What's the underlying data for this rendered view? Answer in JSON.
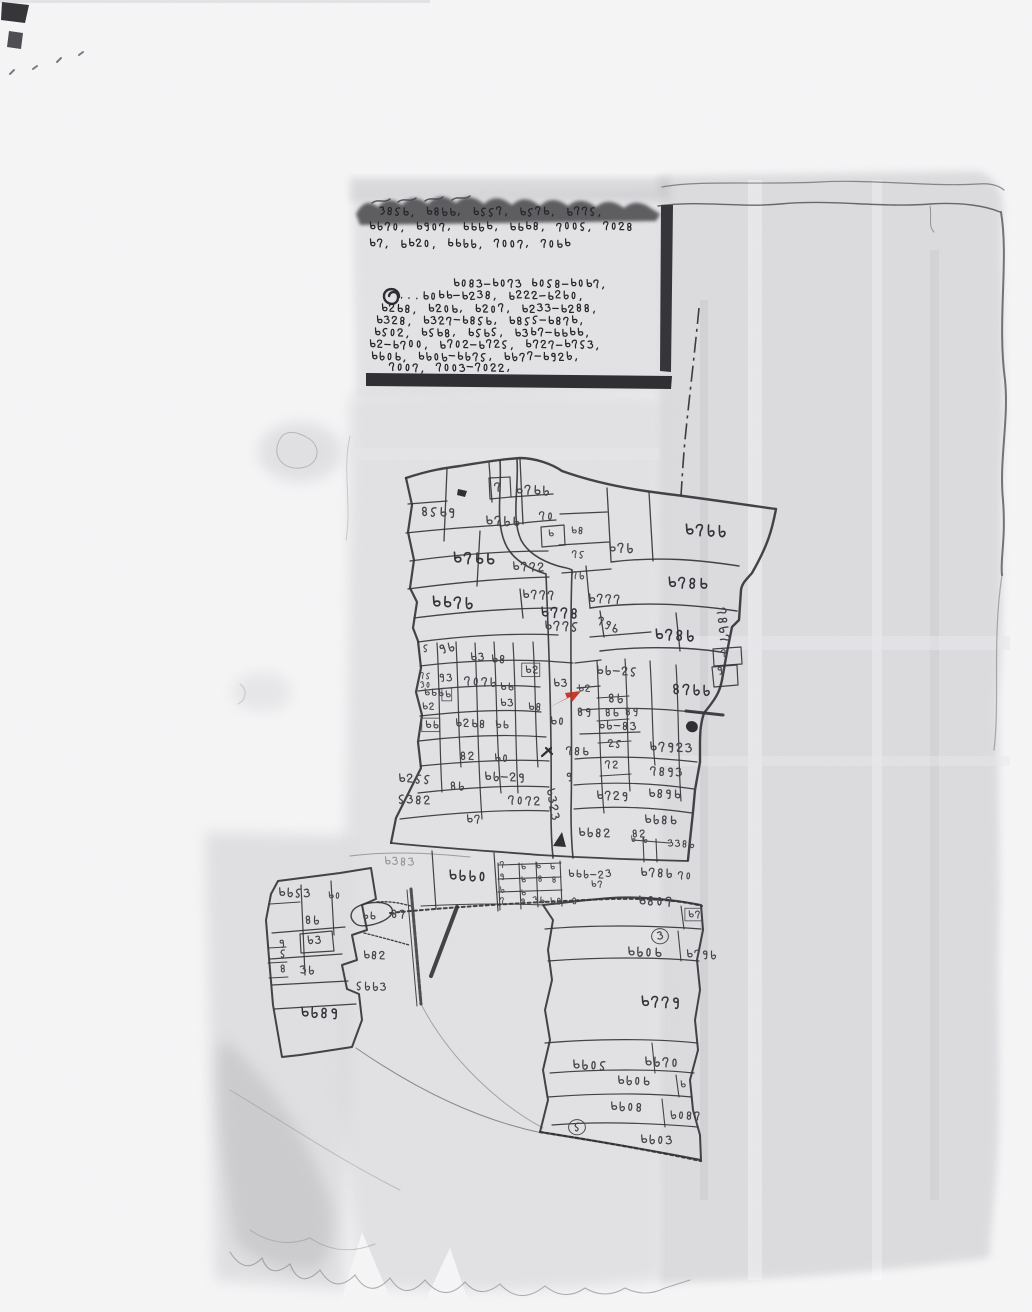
{
  "document": {
    "kind_label": "scanned-hand-drawn-cadastral-mouza-map",
    "ink_color": "#3a3a40",
    "red_mark_color": "#c03026",
    "paper_color": "#f6f6f7",
    "wash_color": "#c9c9cd"
  },
  "notes_block": {
    "lines": [
      {
        "x": 378,
        "y": 206,
        "text": "১৪৫৬, ৬৪৮৬, ৬৫৫৭, ৬৫৭৬, ৬৭৭৫,"
      },
      {
        "x": 368,
        "y": 221,
        "text": "৬৮৭০, ৬৯০৭, ৬৬৮৬, ৬৬৬৪, ৭০০৫, ৭০২৪"
      },
      {
        "x": 368,
        "y": 238,
        "text": "৬৭, ৬৬২০, ৬৬৮৮, ৭০০৭, ৭০৬৬"
      },
      {
        "x": 452,
        "y": 278,
        "text": "৬০৪৩-৬০৭৩ ৬০৫৪-৬০৬৭,"
      },
      {
        "x": 398,
        "y": 290,
        "text": "...৬০৬৬-৬২৩৪, ৬২২২-৬২৮০,"
      },
      {
        "x": 380,
        "y": 303,
        "text": "৬২৬৪, ৬২০৬, ৬২০৭, ৬২৩৩-৬২৪৪,"
      },
      {
        "x": 375,
        "y": 315,
        "text": "৬৩২৪, ৬৩২৭-৬৪৫৬, ৬৪৫৫-৬৪৭৬,"
      },
      {
        "x": 373,
        "y": 327,
        "text": "৬৫০২, ৬৫৬৪, ৬৫৬৫, ৬৩৬৭-৬৬৬৬,"
      },
      {
        "x": 368,
        "y": 339,
        "text": "৬২-৬৭০০, ৬৭০২-৬৭২৫, ৬৭২৭-৬৭৫৩,"
      },
      {
        "x": 370,
        "y": 351,
        "text": "৬৮০৬, ৬৮০৮-৬৮৭৫, ৬৮৭৭-৬৯২৮,"
      },
      {
        "x": 388,
        "y": 362,
        "text": "৭০০৭, ৭০০৩-৭০২২,"
      }
    ]
  },
  "highlight": {
    "red_arrow_plot": "৬৩"
  },
  "map_labels": [
    {
      "x": 493,
      "y": 482,
      "t": "৭"
    },
    {
      "x": 514,
      "y": 484,
      "t": "৬৭৬৮",
      "s": 0.9
    },
    {
      "x": 420,
      "y": 506,
      "t": "৪৫৬৯",
      "s": 0.9
    },
    {
      "x": 484,
      "y": 515,
      "t": "৬৭৮৬",
      "s": 0.9
    },
    {
      "x": 538,
      "y": 511,
      "t": "৭০",
      "s": 0.8
    },
    {
      "x": 547,
      "y": 529,
      "t": "৬",
      "s": 0.7
    },
    {
      "x": 570,
      "y": 526,
      "t": "৬৪",
      "s": 0.7
    },
    {
      "x": 683,
      "y": 523,
      "t": "৬৭৮৮",
      "s": 1.1
    },
    {
      "x": 607,
      "y": 542,
      "t": "৬৭৮",
      "s": 0.9
    },
    {
      "x": 451,
      "y": 551,
      "t": "৬৭৬৬",
      "s": 1.1
    },
    {
      "x": 511,
      "y": 561,
      "t": "৬৭৭২",
      "s": 0.85
    },
    {
      "x": 571,
      "y": 550,
      "t": "৭৫",
      "s": 0.7
    },
    {
      "x": 571,
      "y": 571,
      "t": "৭৮",
      "s": 0.7
    },
    {
      "x": 666,
      "y": 576,
      "t": "৬৭৪৬",
      "s": 1.05
    },
    {
      "x": 430,
      "y": 595,
      "t": "৬৬৭৮",
      "s": 1.1
    },
    {
      "x": 521,
      "y": 589,
      "t": "৬৭৭৭",
      "s": 0.85
    },
    {
      "x": 587,
      "y": 593,
      "t": "৬৭৭৭",
      "s": 0.85
    },
    {
      "x": 539,
      "y": 606,
      "t": "৬৭৭৪",
      "s": 1.0
    },
    {
      "x": 599,
      "y": 615,
      "t": "৭৯৬",
      "s": 0.8,
      "r": 25
    },
    {
      "x": 543,
      "y": 620,
      "t": "৬৭৭৫",
      "s": 0.9
    },
    {
      "x": 653,
      "y": 628,
      "t": "৬৭৪৮",
      "s": 1.05
    },
    {
      "x": 726,
      "y": 606,
      "t": "৭৪৮৭",
      "s": 0.9,
      "r": 80
    },
    {
      "x": 422,
      "y": 644,
      "t": "৫",
      "s": 0.7
    },
    {
      "x": 437,
      "y": 645,
      "t": "৯৮",
      "s": 0.85,
      "r": -15
    },
    {
      "x": 469,
      "y": 652,
      "t": "৬৩",
      "s": 0.8
    },
    {
      "x": 490,
      "y": 654,
      "t": "৬৪",
      "s": 0.8
    },
    {
      "x": 524,
      "y": 665,
      "t": "৬২",
      "s": 0.75,
      "v": "box"
    },
    {
      "x": 552,
      "y": 678,
      "t": "৬৩",
      "s": 0.8
    },
    {
      "x": 499,
      "y": 698,
      "t": "৬৩",
      "s": 0.75
    },
    {
      "x": 527,
      "y": 702,
      "t": "৬৪",
      "s": 0.75
    },
    {
      "x": 595,
      "y": 665,
      "t": "৬৮-২৫",
      "s": 0.85
    },
    {
      "x": 720,
      "y": 649,
      "t": "৭",
      "s": 0.7
    },
    {
      "x": 716,
      "y": 666,
      "t": "৯",
      "s": 0.75
    },
    {
      "x": 671,
      "y": 683,
      "t": "৪৭৮৮",
      "s": 1.0
    },
    {
      "x": 419,
      "y": 672,
      "t": "৭৫",
      "s": 0.6
    },
    {
      "x": 419,
      "y": 681,
      "t": "১০",
      "s": 0.6
    },
    {
      "x": 438,
      "y": 673,
      "t": "৯৩",
      "s": 0.75
    },
    {
      "x": 463,
      "y": 676,
      "t": "৭০৭৮",
      "s": 0.85
    },
    {
      "x": 499,
      "y": 682,
      "t": "৬৬",
      "s": 0.75
    },
    {
      "x": 577,
      "y": 684,
      "t": "৬২",
      "s": 0.7
    },
    {
      "x": 607,
      "y": 693,
      "t": "৪৮",
      "s": 0.85
    },
    {
      "x": 576,
      "y": 707,
      "t": "৪৯",
      "s": 0.8
    },
    {
      "x": 604,
      "y": 708,
      "t": "৪৬",
      "s": 0.75
    },
    {
      "x": 624,
      "y": 707,
      "t": "৪৯",
      "s": 0.75
    },
    {
      "x": 423,
      "y": 688,
      "t": "৬৬৬",
      "s": 0.7
    },
    {
      "x": 444,
      "y": 690,
      "t": "৬",
      "s": 0.7,
      "v": "box"
    },
    {
      "x": 421,
      "y": 702,
      "t": "৬২",
      "s": 0.7
    },
    {
      "x": 549,
      "y": 716,
      "t": "৬০",
      "s": 0.8
    },
    {
      "x": 597,
      "y": 720,
      "t": "৬৮-৪৩",
      "s": 0.8
    },
    {
      "x": 607,
      "y": 739,
      "t": "২৫",
      "s": 0.75
    },
    {
      "x": 424,
      "y": 720,
      "t": "৬৬",
      "s": 0.75,
      "v": "box"
    },
    {
      "x": 454,
      "y": 718,
      "t": "৬২৬৪",
      "s": 0.8
    },
    {
      "x": 494,
      "y": 720,
      "t": "৬৬",
      "s": 0.75
    },
    {
      "x": 565,
      "y": 746,
      "t": "৭৪৬",
      "s": 0.8
    },
    {
      "x": 604,
      "y": 760,
      "t": "৭২",
      "s": 0.75
    },
    {
      "x": 648,
      "y": 741,
      "t": "৬৭৯২৩",
      "s": 0.9
    },
    {
      "x": 649,
      "y": 766,
      "t": "৭৪৯৩",
      "s": 0.85
    },
    {
      "x": 459,
      "y": 751,
      "t": "৪২",
      "s": 0.8
    },
    {
      "x": 493,
      "y": 753,
      "t": "৬০",
      "s": 0.8
    },
    {
      "x": 449,
      "y": 781,
      "t": "৪৮",
      "s": 0.8
    },
    {
      "x": 483,
      "y": 771,
      "t": "৬৮-২৯",
      "s": 0.85
    },
    {
      "x": 565,
      "y": 772,
      "t": "৯",
      "s": 0.8
    },
    {
      "x": 397,
      "y": 773,
      "t": "৬২৫৫",
      "s": 0.85
    },
    {
      "x": 397,
      "y": 794,
      "t": "৫৩৪২",
      "s": 0.85
    },
    {
      "x": 507,
      "y": 795,
      "t": "৭০৭২",
      "s": 0.85
    },
    {
      "x": 555,
      "y": 786,
      "t": "৬৩২৩",
      "s": 0.85,
      "r": 78
    },
    {
      "x": 595,
      "y": 790,
      "t": "৬৭২৯",
      "s": 0.85
    },
    {
      "x": 647,
      "y": 788,
      "t": "৬৪৯৬",
      "s": 0.85
    },
    {
      "x": 643,
      "y": 814,
      "t": "৬৮৪৬",
      "s": 0.85
    },
    {
      "x": 465,
      "y": 814,
      "t": "৬৭",
      "s": 0.8
    },
    {
      "x": 577,
      "y": 827,
      "t": "৬৮৪২",
      "s": 0.85
    },
    {
      "x": 631,
      "y": 829,
      "t": "৪২",
      "s": 0.75
    },
    {
      "x": 667,
      "y": 839,
      "t": "৩৩৪৮",
      "s": 0.7
    },
    {
      "x": 383,
      "y": 856,
      "t": "৬৩৪৩",
      "s": 0.8,
      "c": "faint"
    },
    {
      "x": 447,
      "y": 869,
      "t": "৬৮৮০",
      "s": 1.0
    },
    {
      "x": 499,
      "y": 861,
      "t": "৭",
      "s": 0.6
    },
    {
      "x": 499,
      "y": 873,
      "t": "৯",
      "s": 0.6
    },
    {
      "x": 499,
      "y": 886,
      "t": "৮",
      "s": 0.6
    },
    {
      "x": 499,
      "y": 897,
      "t": "৭",
      "s": 0.6
    },
    {
      "x": 520,
      "y": 863,
      "t": "৬",
      "s": 0.6
    },
    {
      "x": 520,
      "y": 876,
      "t": "৬",
      "s": 0.6
    },
    {
      "x": 520,
      "y": 889,
      "t": "৬",
      "s": 0.6
    },
    {
      "x": 520,
      "y": 898,
      "t": "৯",
      "s": 0.6
    },
    {
      "x": 535,
      "y": 862,
      "t": "৬",
      "s": 0.6
    },
    {
      "x": 549,
      "y": 863,
      "t": "৬",
      "s": 0.6
    },
    {
      "x": 537,
      "y": 875,
      "t": "৪",
      "s": 0.6
    },
    {
      "x": 551,
      "y": 876,
      "t": "৪",
      "s": 0.6
    },
    {
      "x": 567,
      "y": 869,
      "t": "৬৬৮-২৩",
      "s": 0.75
    },
    {
      "x": 590,
      "y": 880,
      "t": "৬৭",
      "s": 0.65
    },
    {
      "x": 639,
      "y": 867,
      "t": "৬৭৪৮",
      "s": 0.85
    },
    {
      "x": 677,
      "y": 871,
      "t": "৭০",
      "s": 0.75
    },
    {
      "x": 532,
      "y": 896,
      "t": "৩৬",
      "s": 0.65
    },
    {
      "x": 549,
      "y": 897,
      "t": "৬৪",
      "s": 0.65
    },
    {
      "x": 571,
      "y": 897,
      "t": "৪",
      "s": 0.65
    },
    {
      "x": 637,
      "y": 895,
      "t": "৬৪০৭",
      "s": 0.9
    },
    {
      "x": 687,
      "y": 910,
      "t": "৬৭",
      "s": 0.7,
      "v": "box"
    },
    {
      "x": 630,
      "y": 835,
      "t": "৮",
      "s": 0.6
    },
    {
      "x": 642,
      "y": 836,
      "t": "৮",
      "s": 0.6
    },
    {
      "x": 277,
      "y": 887,
      "t": "৬৮৫৩",
      "s": 0.85
    },
    {
      "x": 327,
      "y": 891,
      "t": "৬০",
      "s": 0.7
    },
    {
      "x": 361,
      "y": 911,
      "t": "৬৬",
      "s": 0.75
    },
    {
      "x": 390,
      "y": 909,
      "t": "৪৭",
      "s": 0.8
    },
    {
      "x": 304,
      "y": 915,
      "t": "৪৮",
      "s": 0.8
    },
    {
      "x": 306,
      "y": 935,
      "t": "৮৩",
      "s": 0.8
    },
    {
      "x": 278,
      "y": 939,
      "t": "৯",
      "s": 0.75
    },
    {
      "x": 279,
      "y": 949,
      "t": "৫",
      "s": 0.75
    },
    {
      "x": 362,
      "y": 950,
      "t": "৬৪২",
      "s": 0.8
    },
    {
      "x": 299,
      "y": 965,
      "t": "৩৮",
      "s": 0.8
    },
    {
      "x": 279,
      "y": 964,
      "t": "৪",
      "s": 0.75
    },
    {
      "x": 355,
      "y": 981,
      "t": "৫৮৮৩",
      "s": 0.8
    },
    {
      "x": 299,
      "y": 1006,
      "t": "৬৮৪৯",
      "s": 1.0
    },
    {
      "x": 626,
      "y": 946,
      "t": "৬৮০৬",
      "s": 0.9
    },
    {
      "x": 685,
      "y": 949,
      "t": "৬৭৯৮",
      "s": 0.8
    },
    {
      "x": 656,
      "y": 931,
      "t": "৩",
      "s": 0.8,
      "v": "circle"
    },
    {
      "x": 639,
      "y": 995,
      "t": "৬৭৭৯",
      "s": 1.05
    },
    {
      "x": 571,
      "y": 1059,
      "t": "৬৮০৫",
      "s": 0.9
    },
    {
      "x": 643,
      "y": 1056,
      "t": "৬৮৭০",
      "s": 0.9
    },
    {
      "x": 616,
      "y": 1075,
      "t": "৬৮০৬",
      "s": 0.85
    },
    {
      "x": 679,
      "y": 1080,
      "t": "৬",
      "s": 0.7
    },
    {
      "x": 609,
      "y": 1101,
      "t": "৬৮০৪",
      "s": 0.85
    },
    {
      "x": 669,
      "y": 1110,
      "t": "৮০৪৭",
      "s": 0.8
    },
    {
      "x": 573,
      "y": 1122,
      "t": "৫",
      "s": 0.8,
      "v": "circle"
    },
    {
      "x": 639,
      "y": 1134,
      "t": "৬৮০৩",
      "s": 0.85
    }
  ]
}
